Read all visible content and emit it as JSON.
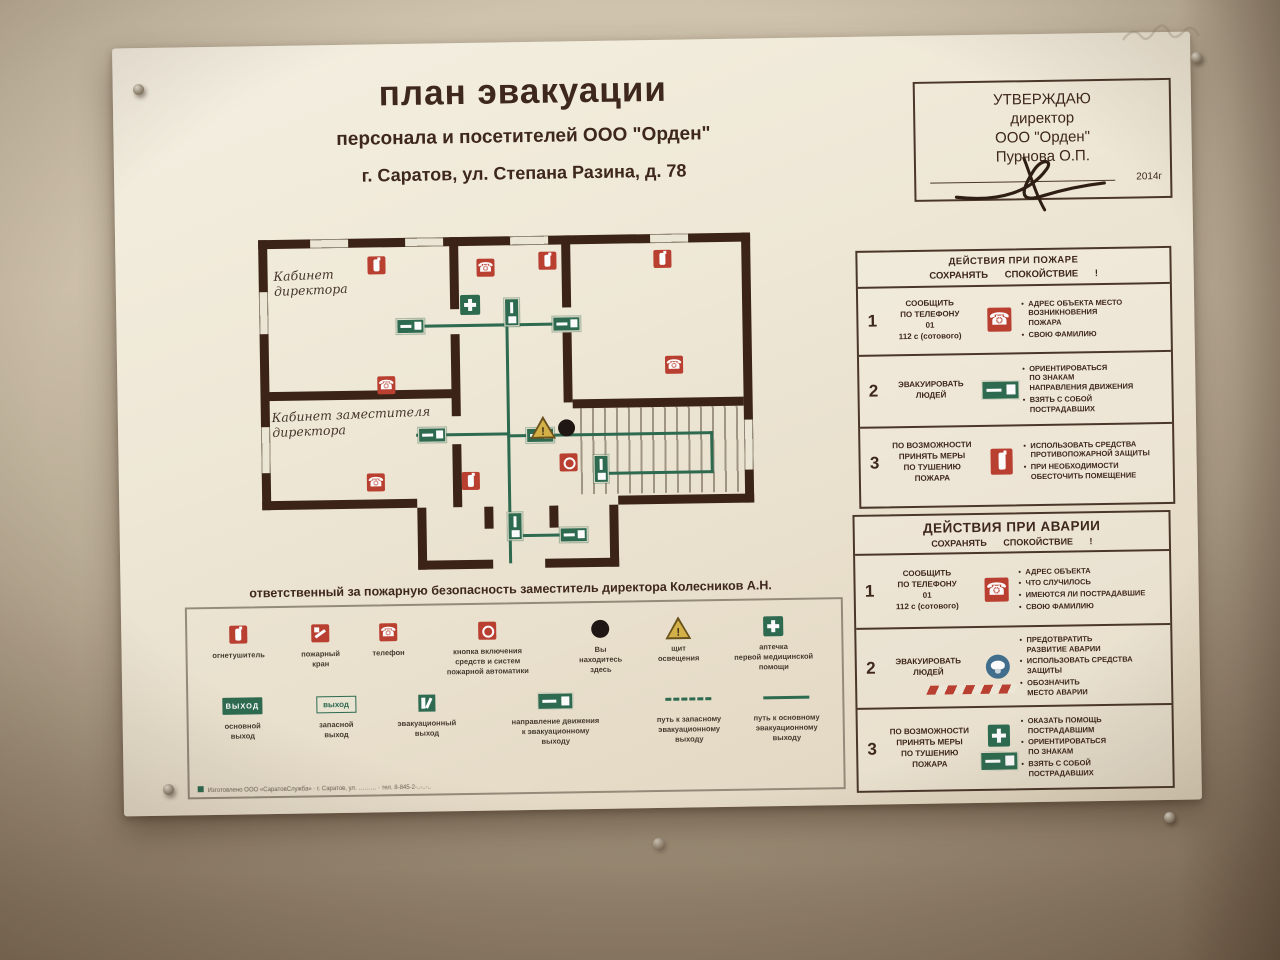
{
  "poster": {
    "title": "план эвакуации",
    "subtitle": "персонала и посетителей ООО \"Орден\"",
    "address": "г. Саратов, ул. Степана Разина, д. 78",
    "approval": {
      "heading": "УТВЕРЖДАЮ",
      "role": "директор",
      "org": "ООО \"Орден\"",
      "name": "Пурнова О.П.",
      "year": "2014г"
    },
    "plan": {
      "room1": "Кабинет\nдиректора",
      "room2": "Кабинет заместителя\nдиректора"
    },
    "responsible_line": "ответственный за пожарную безопасность заместитель директора Колесников А.Н.",
    "legend": {
      "row1": [
        {
          "icon": "fire-extinguisher",
          "label": "огнетушитель"
        },
        {
          "icon": "fire-hydrant",
          "label": "пожарный\nкран"
        },
        {
          "icon": "telephone",
          "label": "телефон"
        },
        {
          "icon": "fire-automatics-button",
          "label": "кнопка включения\nсредств и систем\nпожарной автоматики"
        },
        {
          "icon": "you-are-here",
          "label": "Вы\nнаходитесь\nздесь"
        },
        {
          "icon": "warning-triangle",
          "label": "щит\nосвещения"
        },
        {
          "icon": "first-aid-kit",
          "label": "аптечка\nпервой медицинской\nпомощи"
        }
      ],
      "row2": [
        {
          "icon": "exit-sign-solid",
          "sign_text": "ВЫХОД",
          "label": "основной\nвыход"
        },
        {
          "icon": "exit-sign-outline",
          "sign_text": "выход",
          "label": "запасной\nвыход"
        },
        {
          "icon": "evacuation-exit",
          "label": "эвакуационный\nвыход"
        },
        {
          "icon": "direction-sign",
          "label": "направление движения\nк эвакуационному\nвыходу"
        },
        {
          "icon": "dashed-route",
          "label": "путь к запасному\nэвакуационному\nвыходу"
        },
        {
          "icon": "solid-route",
          "label": "путь к основному\nэвакуационному\nвыходу"
        }
      ],
      "footer": "Изготовлено ООО «СаратовСлужба» · г. Саратов, ул. ……… · тел. 8-845-2-..-..-.."
    },
    "fire_panel": {
      "title": "ДЕЙСТВИЯ ПРИ ПОЖАРЕ",
      "subtitle": "СОХРАНЯТЬ СПОКОЙСТВИЕ !",
      "rows": [
        {
          "num": "1",
          "action": "СООБЩИТЬ\nПО ТЕЛЕФОНУ\n01\n112 с (сотового)",
          "icon": "telephone",
          "points": [
            "АДРЕС ОБЪЕКТА МЕСТО\nВОЗНИКНОВЕНИЯ\nПОЖАРА",
            "СВОЮ ФАМИЛИЮ"
          ]
        },
        {
          "num": "2",
          "action": "ЭВАКУИРОВАТЬ\nЛЮДЕЙ",
          "icon": "exit-direction-sign",
          "points": [
            "ОРИЕНТИРОВАТЬСЯ\nПО ЗНАКАМ\nНАПРАВЛЕНИЯ ДВИЖЕНИЯ",
            "ВЗЯТЬ С СОБОЙ\nПОСТРАДАВШИХ"
          ]
        },
        {
          "num": "3",
          "action": "ПО ВОЗМОЖНОСТИ\nПРИНЯТЬ МЕРЫ\nПО ТУШЕНИЮ\nПОЖАРА",
          "icon": "fire-extinguisher",
          "points": [
            "ИСПОЛЬЗОВАТЬ СРЕДСТВА\nПРОТИВОПОЖАРНОЙ ЗАЩИТЫ",
            "ПРИ НЕОБХОДИМОСТИ\nОБЕСТОЧИТЬ ПОМЕЩЕНИЕ"
          ]
        }
      ]
    },
    "accident_panel": {
      "title": "ДЕЙСТВИЯ ПРИ АВАРИИ",
      "subtitle": "СОХРАНЯТЬ СПОКОЙСТВИЕ !",
      "rows": [
        {
          "num": "1",
          "action": "СООБЩИТЬ\nПО ТЕЛЕФОНУ\n01\n112 с (сотового)",
          "icon": "telephone",
          "points": [
            "АДРЕС ОБЪЕКТА",
            "ЧТО СЛУЧИЛОСЬ",
            "ИМЕЮТСЯ ЛИ ПОСТРАДАВШИЕ",
            "СВОЮ ФАМИЛИЮ"
          ]
        },
        {
          "num": "2",
          "action": "ЭВАКУИРОВАТЬ\nЛЮДЕЙ",
          "icon": "gas-mask-and-hazard-stripe",
          "points": [
            "ПРЕДОТВРАТИТЬ\nРАЗВИТИЕ АВАРИИ",
            "ИСПОЛЬЗОВАТЬ СРЕДСТВА\nЗАЩИТЫ",
            "ОБОЗНАЧИТЬ\nМЕСТО АВАРИИ"
          ]
        },
        {
          "num": "3",
          "action": "ПО ВОЗМОЖНОСТИ\nПРИНЯТЬ МЕРЫ\nПО ТУШЕНИЮ\nПОЖАРА",
          "icon": "first-aid-and-exit-sign",
          "points": [
            "ОКАЗАТЬ ПОМОЩЬ\nПОСТРАДАВШИМ",
            "ОРИЕНТИРОВАТЬСЯ\nПО ЗНАКАМ",
            "ВЗЯТЬ С СОБОЙ\nПОСТРАДАВШИХ"
          ]
        }
      ]
    }
  },
  "colors": {
    "accent_red": "#c23b2a",
    "accent_green": "#276b4e",
    "wall_brown": "#3a2113",
    "paper": "#f2ecdc",
    "ink": "#3d2418",
    "warning_yellow": "#d9b13f",
    "mask_blue": "#3c6e8f"
  }
}
